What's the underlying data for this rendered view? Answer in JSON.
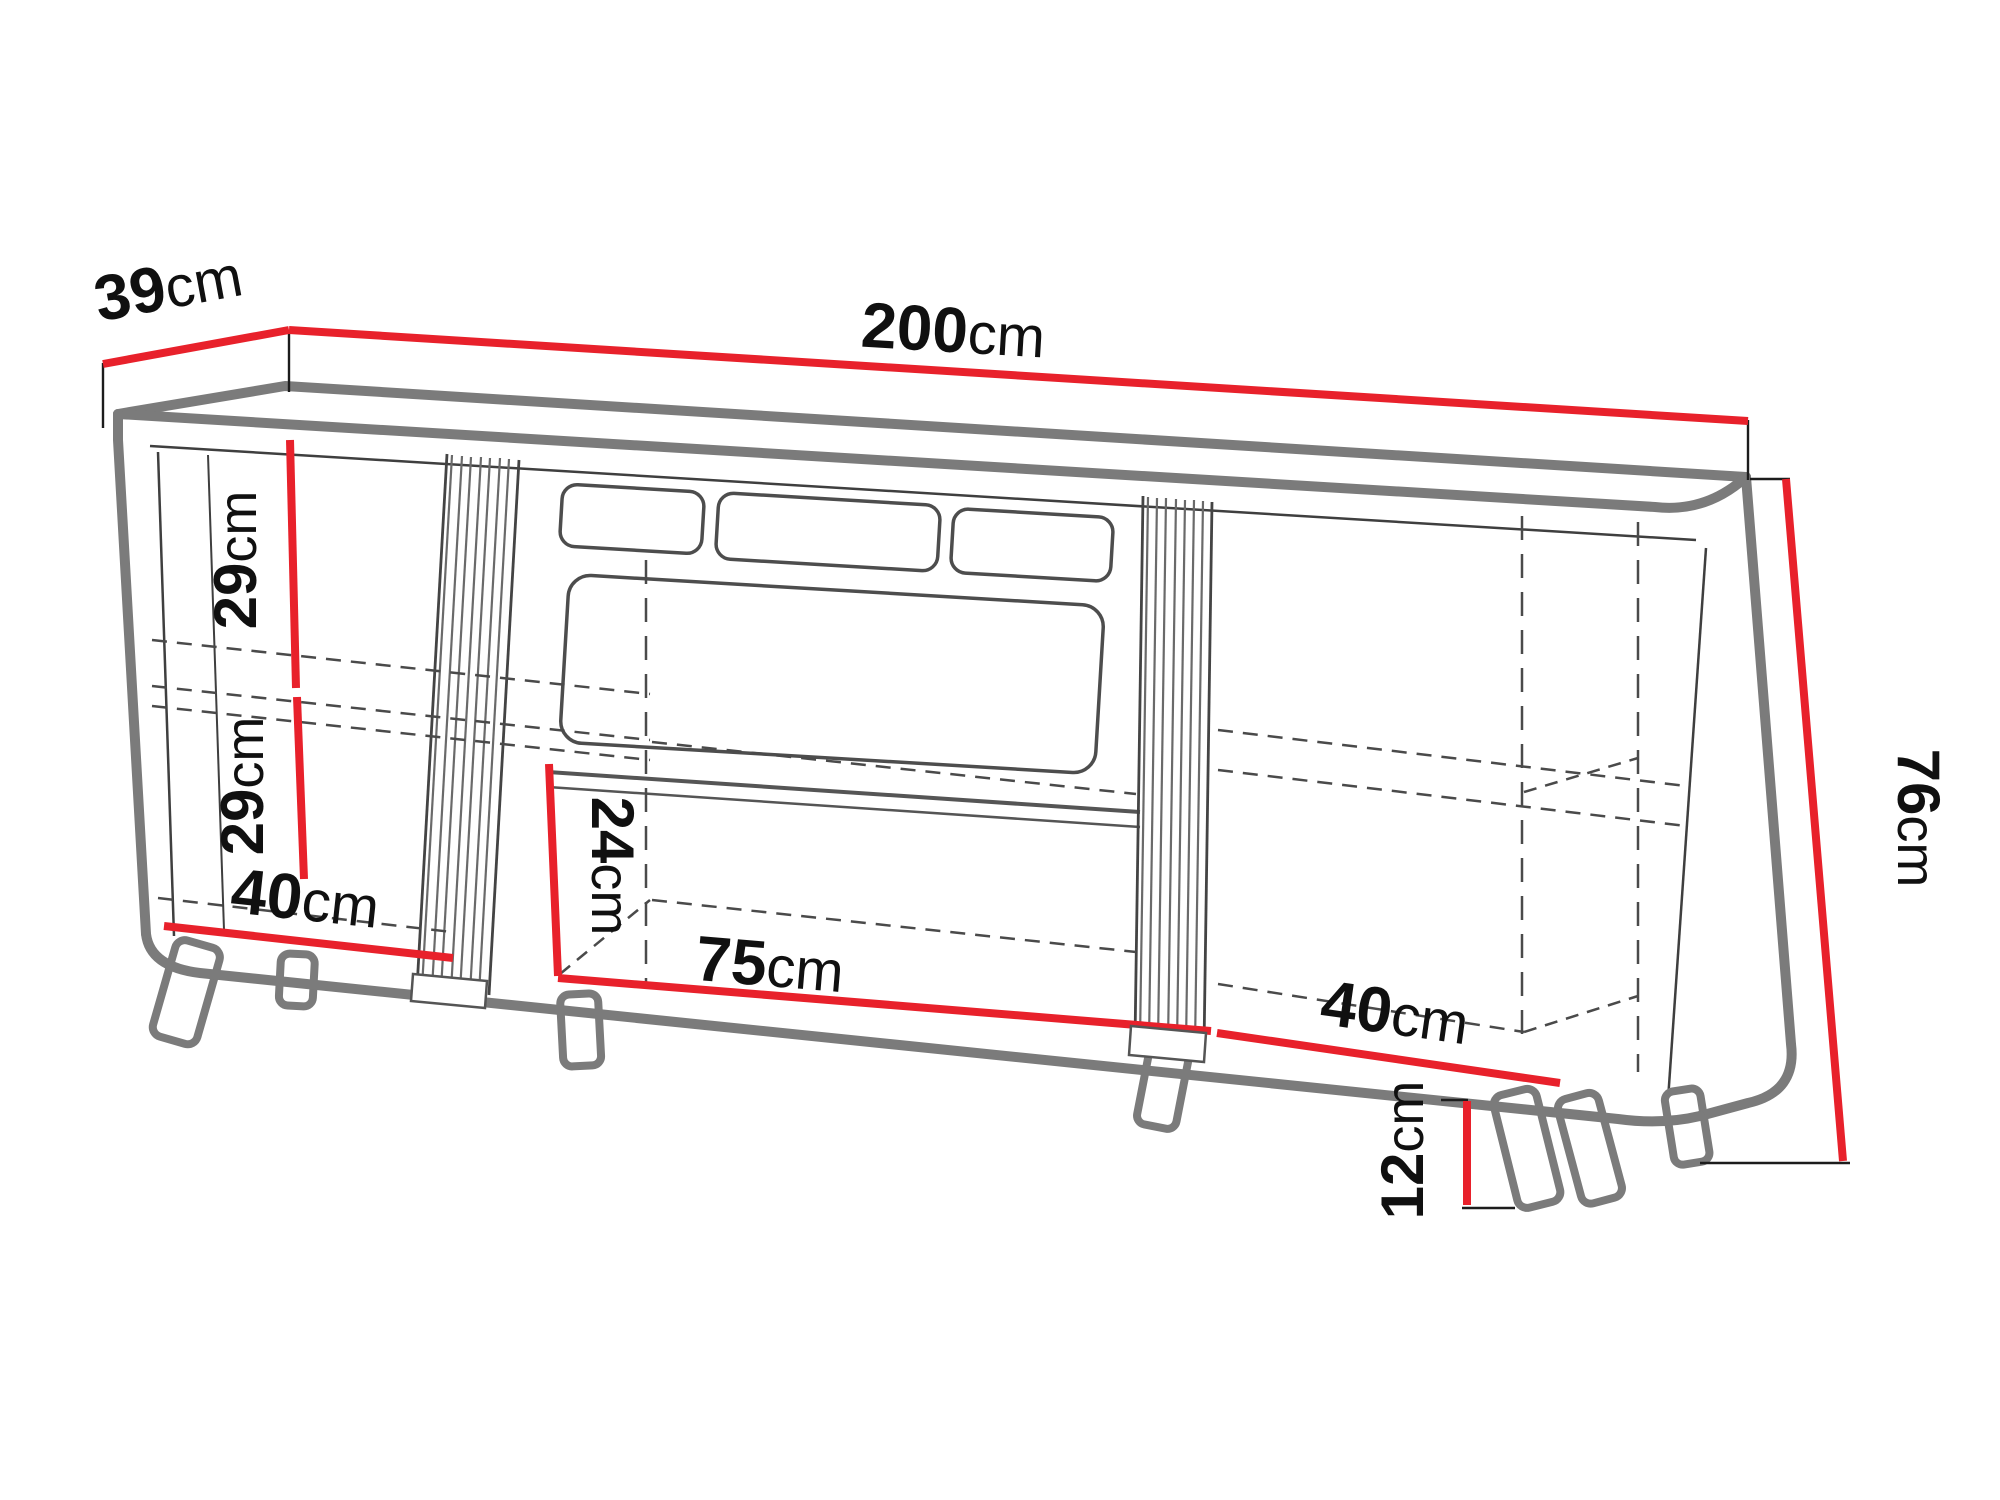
{
  "diagram": {
    "colors": {
      "dimension_red": "#e8212b",
      "outline_gray": "#7b7b7b",
      "detail_gray": "#4a4a4a",
      "text_black": "#101010",
      "background": "#ffffff"
    },
    "dimensions": [
      {
        "id": "depth-top",
        "value": "39",
        "unit": "cm"
      },
      {
        "id": "width-total",
        "value": "200",
        "unit": "cm"
      },
      {
        "id": "left-upper-height",
        "value": "29",
        "unit": "cm"
      },
      {
        "id": "left-lower-height",
        "value": "29",
        "unit": "cm"
      },
      {
        "id": "left-bottom-width",
        "value": "40",
        "unit": "cm"
      },
      {
        "id": "center-niche-height",
        "value": "24",
        "unit": "cm"
      },
      {
        "id": "center-bottom-width",
        "value": "75",
        "unit": "cm"
      },
      {
        "id": "right-bottom-width",
        "value": "40",
        "unit": "cm"
      },
      {
        "id": "total-height",
        "value": "76",
        "unit": "cm"
      },
      {
        "id": "leg-height",
        "value": "12",
        "unit": "cm"
      }
    ]
  }
}
